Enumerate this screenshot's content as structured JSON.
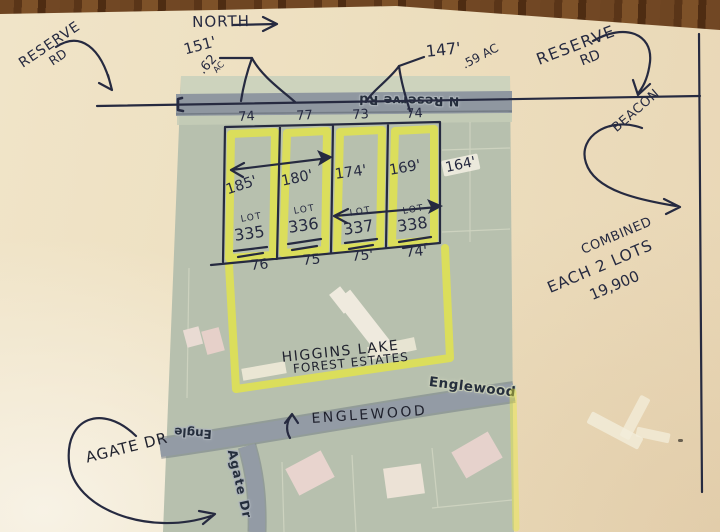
{
  "annotations": {
    "north": "NORTH",
    "reserve_left_line1": "RESERVE",
    "reserve_left_line2": "RD",
    "reserve_right_line1": "RESERVE",
    "reserve_right_line2": "RD",
    "dim_151": "151'",
    "dim_147": "147'",
    "acreage_left_value": ".62",
    "acreage_left_unit": "AC",
    "acreage_right": ".59 AC",
    "beacon": "BEACON",
    "combined_line1": "COMBINED",
    "combined_line2": "EACH 2 LOTS",
    "combined_line3": "19,900",
    "higgins_line1": "HIGGINS LAKE",
    "higgins_line2": "FOREST ESTATES",
    "englewood": "ENGLEWOOD",
    "agate": "AGATE DR",
    "dim_164": "164'"
  },
  "lots": [
    {
      "front": "74",
      "depth": "185'",
      "label": "LOT",
      "number": "335",
      "rear": "76"
    },
    {
      "front": "77",
      "depth": "180'",
      "label": "LOT",
      "number": "336",
      "rear": "75"
    },
    {
      "front": "73",
      "depth": "174'",
      "label": "LOT",
      "number": "337",
      "rear": "75'"
    },
    {
      "front": "74",
      "depth": "169'",
      "label": "LOT",
      "number": "338",
      "rear": "74'"
    }
  ],
  "printed_map": {
    "road_top_label": "N Reserve Rd",
    "englewood_label": "Englewood",
    "engle_partial_label": "Engle",
    "agate_label": "Agate Dr"
  },
  "colors": {
    "highlighter_yellow": "#e8e836",
    "pen_ink": "#262a40",
    "map_green": "#b7c0ae",
    "road_gray": "#8f97a0",
    "paper_cream": "#eddfbf"
  }
}
